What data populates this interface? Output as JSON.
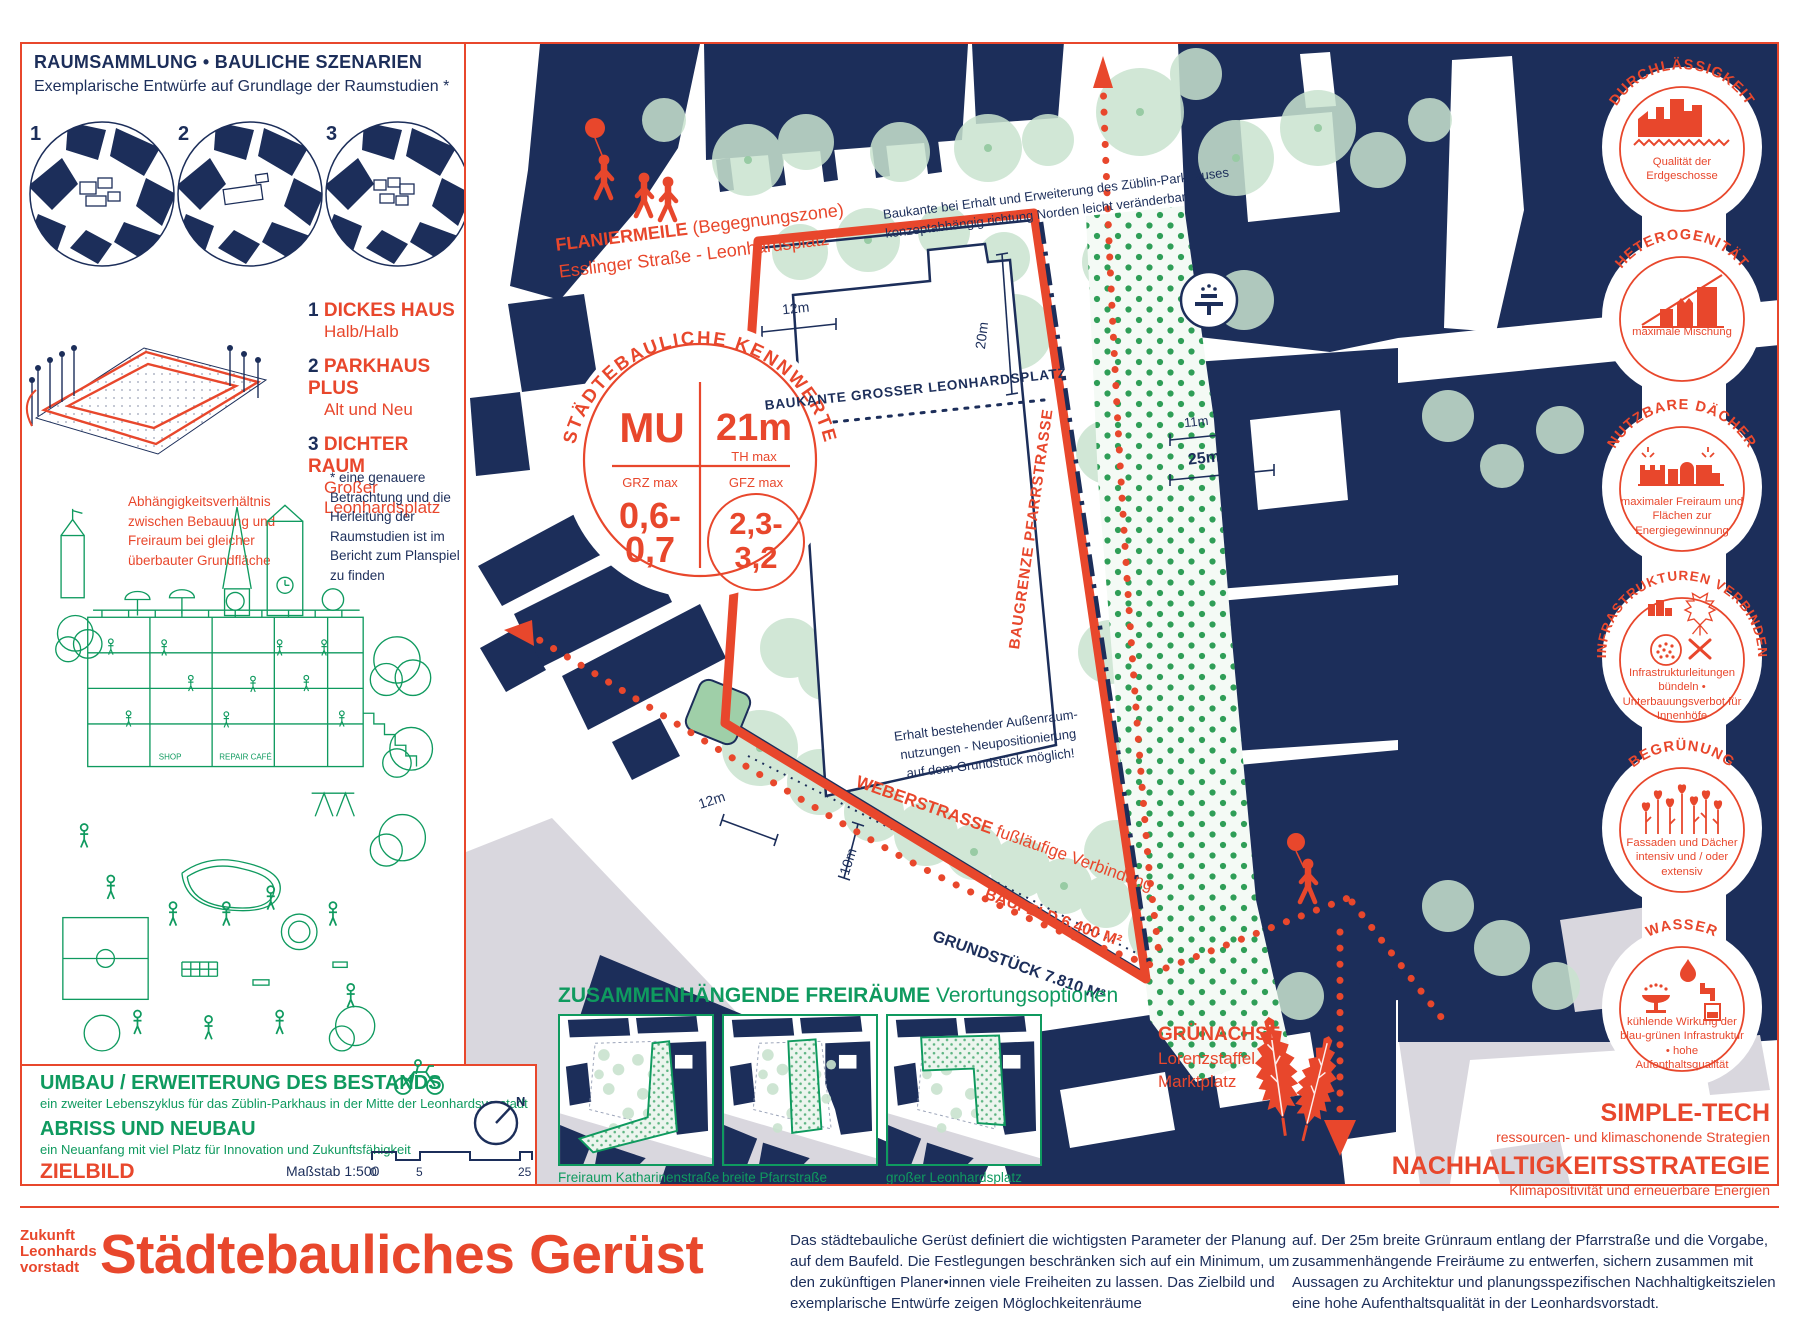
{
  "colors": {
    "navy": "#1C2E5A",
    "red": "#E8472C",
    "green": "#0F9A5F",
    "tree_green": "#C9E3CF",
    "dot_green": "#2F9E57",
    "street_gray": "#D9D7DE"
  },
  "left_panel": {
    "title": "RAUMSAMMLUNG • BAULICHE SZENARIEN",
    "subtitle": "Exemplarische Entwürfe auf Grundlage der Raumstudien *",
    "scenario_numbers": [
      "1",
      "2",
      "3"
    ],
    "legend": [
      {
        "num": "1",
        "title": "DICKES HAUS",
        "sub": "Halb/Halb"
      },
      {
        "num": "2",
        "title": "PARKHAUS PLUS",
        "sub": "Alt und Neu"
      },
      {
        "num": "3",
        "title": "DICHTER RAUM",
        "sub": "Großer Leonhardsplatz"
      }
    ],
    "dependency_note": "Abhängigkeitsverhältnis zwischen Bebauung und Freiraum bei gleicher überbauter Grundfläche",
    "asterisk_note": "* eine genauere Betrachtung und die Herleitung der Raumstudien ist im Bericht zum Planspiel zu finden",
    "illustration_labels": {
      "shop": "SHOP",
      "repair": "REPAIR CAFÉ"
    },
    "umbau": {
      "title": "UMBAU / ERWEITERUNG DES BESTANDS",
      "sub": "ein zweiter Lebenszyklus für das Züblin-Parkhaus in der Mitte der Leonhardsvorstadt"
    },
    "abriss": {
      "title": "ABRISS UND NEUBAU",
      "sub": "ein Neuanfang mit viel Platz für Innovation und Zukunftsfähigkeit"
    },
    "zielbild": "ZIELBILD",
    "massstab": "Maßstab 1:500",
    "scale_ticks": [
      "0",
      "5",
      "25"
    ],
    "compass_n": "N"
  },
  "map": {
    "flaniermeile_bold": "FLANIERMEILE",
    "flaniermeile_rest": " (Begegnungszone)",
    "flaniermeile_line2": "Esslinger Straße - Leonhardsplatz",
    "baukante_note_1": "Baukante bei Erhalt und Erweiterung des Züblin-Parkhauses",
    "baukante_note_2": "konzeptabhängig richtung Norden leicht veränderbar",
    "baukante_grosser": "BAUKANTE GROSSER LEONHARDSPLATZ",
    "baugrenze": "BAUGRENZE PFARRSTRASSE",
    "erhalt_note_1": "Erhalt bestehender Außenraum-",
    "erhalt_note_2": "nutzungen - Neupositionierung",
    "erhalt_note_3": "auf dem Grundstück möglich!",
    "weber_bold": "WEBERSTRASSE",
    "weber_rest": " fußläufige Verbindung",
    "baufeld": "BAUFELD 6.400 M²",
    "grundstueck": "GRUNDSTÜCK 7.810 M²",
    "gruenachse_title": "GRÜNACHSE",
    "gruenachse_line2": "Lorenzstaffel -",
    "gruenachse_line3": "Marktplatz",
    "dims": {
      "top_gap": "12m",
      "depth": "20m",
      "green_inner": "11m",
      "green_width": "25m",
      "street_left": "12m",
      "corner": "10m"
    },
    "kennwerte": {
      "arc": "STÄDTEBAULICHE KENNWERTE",
      "mu": "MU",
      "th": "21m",
      "th_label": "TH max",
      "grz_label": "GRZ max",
      "grz_1": "0,6-",
      "grz_2": "0,7",
      "gfz_label": "GFZ max",
      "gfz_1": "2,3-",
      "gfz_2": "3,2"
    }
  },
  "badges": [
    {
      "title": "DURCHLÄSSIGKEIT",
      "caption": "Qualität der Erdgeschosse"
    },
    {
      "title": "HETEROGENITÄT",
      "caption": "maximale Mischung"
    },
    {
      "title": "NUTZBARE DÄCHER",
      "caption": "maximaler Freiraum und Flächen zur Energiegewinnung"
    },
    {
      "title": "INFRASTRUKTUREN VERBINDEN",
      "caption": "Infrastrukturleitungen bündeln • Unterbauungsverbot für Innenhöfe"
    },
    {
      "title": "BEGRÜNUNG",
      "caption": "Fassaden und Dächer intensiv und / oder extensiv"
    },
    {
      "title": "WASSER",
      "caption": "kühlende Wirkung der blau-grünen Infrastruktur • hohe Aufenthaltsqualität"
    }
  ],
  "sustainability": {
    "simple_tech_title": "SIMPLE-TECH",
    "simple_tech_sub": "ressourcen- und klimaschonende Strategien",
    "strategy_title": "NACHHALTIGKEITSSTRATEGIE",
    "strategy_sub": "Klimapositivität und erneuerbare Energien"
  },
  "freiraeume": {
    "heading_bold": "ZUSAMMENHÄNGENDE FREIRÄUME",
    "heading_rest": " Verortungsoptionen",
    "maps": [
      {
        "caption": "Freiraum Katharinenstraße"
      },
      {
        "caption": "breite Pfarrstraße"
      },
      {
        "caption": "großer Leonhardsplatz"
      }
    ]
  },
  "footer": {
    "logo_line1": "Zukunft",
    "logo_line2": "Leonhards",
    "logo_line3": "vorstadt",
    "title": "Städtebauliches Gerüst",
    "col1": "Das städtebauliche Gerüst definiert die wichtigsten Parameter der Planung auf dem Baufeld. Die Festlegungen beschränken sich auf ein Minimum, um den zukünftigen Planer•innen viele Freiheiten zu lassen. Das Zielbild und exemplarische Entwürfe zeigen Möglochkeitenräume",
    "col2": "auf. Der 25m breite Grünraum entlang der Pfarrstraße und die Vorgabe, zusammenhängende Freiräume zu entwerfen, sichern zusammen mit Aussagen zu Architektur und planungsspezifischen Nachhaltigkeitszielen eine hohe Aufenthaltsqualität in der Leonhardsvorstadt."
  }
}
